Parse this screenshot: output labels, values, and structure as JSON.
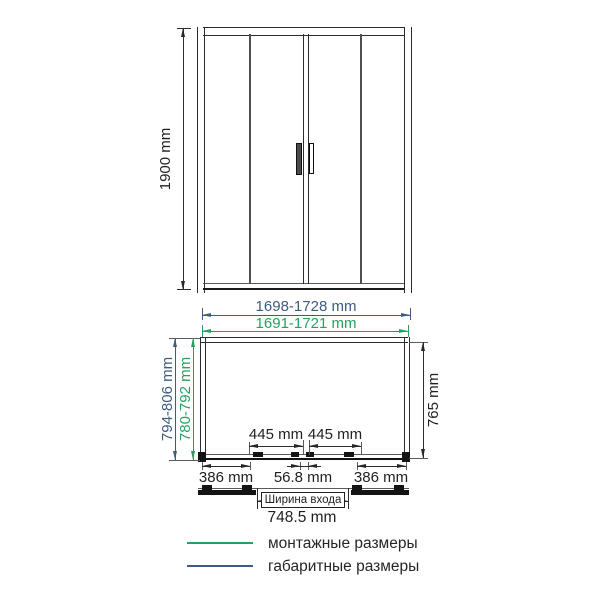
{
  "colors": {
    "mounting_green": "#27a05f",
    "overall_blue": "#3d5c80",
    "ink": "#262626"
  },
  "front_view": {
    "height": "1900 mm"
  },
  "plan_view": {
    "overall_width": "1698-1728 mm",
    "mounting_width": "1691-1721 mm",
    "overall_depth": "794-806 mm",
    "mounting_depth": "780-792 mm",
    "side_depth": "765 mm",
    "door_panel_left": "445 mm",
    "door_panel_right": "445 mm",
    "fixed_panel_left": "386 mm",
    "center_overlap": "56.8 mm",
    "fixed_panel_right": "386 mm",
    "entrance": {
      "label": "Ширина входа",
      "value": "748.5 mm"
    }
  },
  "legend": {
    "mounting_label": "монтажные размеры",
    "overall_label": "габаритные размеры"
  }
}
